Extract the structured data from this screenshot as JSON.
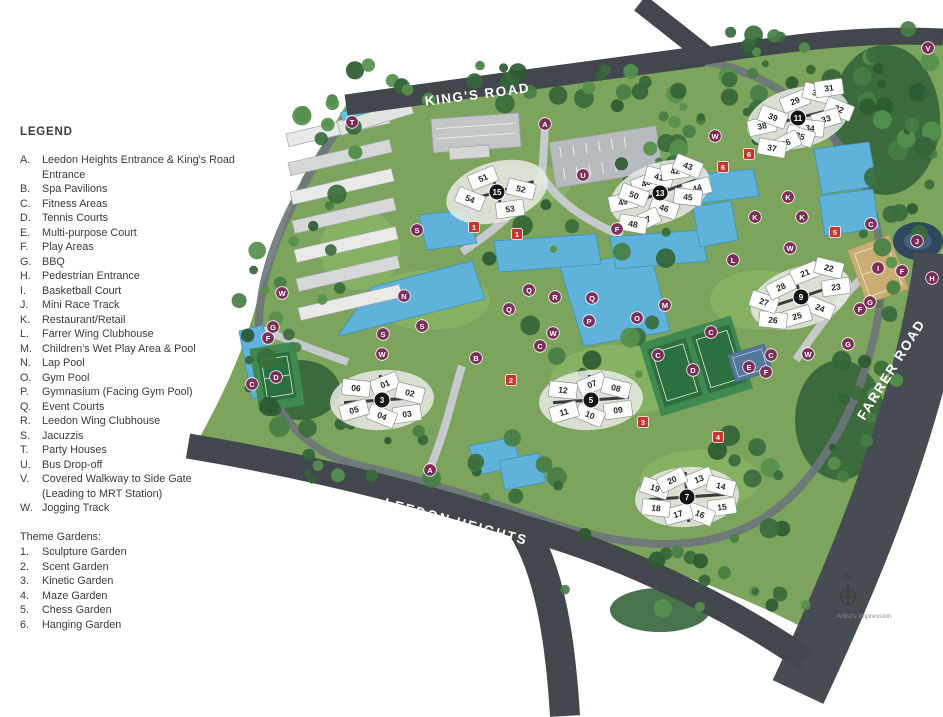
{
  "legend": {
    "title": "LEGEND",
    "items": [
      {
        "key": "A.",
        "label": "Leedon Heights Entrance & King's Road Entrance"
      },
      {
        "key": "B.",
        "label": "Spa Pavilions"
      },
      {
        "key": "C.",
        "label": "Fitness Areas"
      },
      {
        "key": "D.",
        "label": "Tennis Courts"
      },
      {
        "key": "E.",
        "label": "Multi-purpose Court"
      },
      {
        "key": "F.",
        "label": "Play Areas"
      },
      {
        "key": "G.",
        "label": "BBQ"
      },
      {
        "key": "H.",
        "label": "Pedestrian Entrance"
      },
      {
        "key": "I.",
        "label": "Basketball Court"
      },
      {
        "key": "J.",
        "label": "Mini Race Track"
      },
      {
        "key": "K.",
        "label": "Restaurant/Retail"
      },
      {
        "key": "L.",
        "label": "Farrer Wing Clubhouse"
      },
      {
        "key": "M.",
        "label": "Children's Wet Play Area & Pool"
      },
      {
        "key": "N.",
        "label": "Lap Pool"
      },
      {
        "key": "O.",
        "label": "Gym Pool"
      },
      {
        "key": "P.",
        "label": "Gymnasium (Facing Gym Pool)"
      },
      {
        "key": "Q.",
        "label": "Event Courts"
      },
      {
        "key": "R.",
        "label": "Leedon Wing Clubhouse"
      },
      {
        "key": "S.",
        "label": "Jacuzzis"
      },
      {
        "key": "T.",
        "label": "Party Houses"
      },
      {
        "key": "U.",
        "label": "Bus Drop-off"
      },
      {
        "key": "V.",
        "label": "Covered Walkway to Side Gate",
        "label2": "(Leading to MRT Station)"
      },
      {
        "key": "W.",
        "label": "Jogging Track"
      }
    ],
    "theme_gardens": {
      "title": "Theme Gardens:",
      "items": [
        {
          "key": "1.",
          "label": "Sculpture Garden"
        },
        {
          "key": "2.",
          "label": "Scent Garden"
        },
        {
          "key": "3.",
          "label": "Kinetic Garden"
        },
        {
          "key": "4.",
          "label": "Maze Garden"
        },
        {
          "key": "5.",
          "label": "Chess Garden"
        },
        {
          "key": "6.",
          "label": "Hanging Garden"
        }
      ]
    }
  },
  "map": {
    "roads": [
      {
        "name": "KING'S ROAD"
      },
      {
        "name": "FARRER ROAD"
      },
      {
        "name": "LEEDON HEIGHTS"
      }
    ],
    "compass": {
      "label": "N"
    },
    "caption": "Artist's Impression",
    "colors": {
      "road_dark": "#41474d",
      "site_green": "#7da45c",
      "tree_green": "#35663c",
      "pool_blue": "#5fb3da",
      "court_green": "#2c7040",
      "basketball_tan": "#c9ad73",
      "facility_marker": "#7d2857",
      "garden_marker": "#c9342b",
      "block_circle": "#141414"
    },
    "clusters": [
      {
        "block": "15",
        "cx": 497,
        "cy": 192,
        "tilt": -16,
        "buildings": [
          {
            "n": "51",
            "x": 483,
            "y": 178
          },
          {
            "n": "52",
            "x": 521,
            "y": 189
          },
          {
            "n": "53",
            "x": 510,
            "y": 209
          },
          {
            "n": "54",
            "x": 470,
            "y": 199
          }
        ]
      },
      {
        "block": "13",
        "cx": 660,
        "cy": 193,
        "tilt": -20,
        "buildings": [
          {
            "n": "40",
            "x": 646,
            "y": 183
          },
          {
            "n": "41",
            "x": 659,
            "y": 177
          },
          {
            "n": "42",
            "x": 675,
            "y": 171
          },
          {
            "n": "43",
            "x": 688,
            "y": 166
          },
          {
            "n": "44",
            "x": 697,
            "y": 188
          },
          {
            "n": "45",
            "x": 688,
            "y": 197
          },
          {
            "n": "46",
            "x": 664,
            "y": 208
          },
          {
            "n": "47",
            "x": 646,
            "y": 220
          },
          {
            "n": "48",
            "x": 633,
            "y": 224
          },
          {
            "n": "49",
            "x": 623,
            "y": 202
          },
          {
            "n": "50",
            "x": 634,
            "y": 195
          }
        ]
      },
      {
        "block": "11",
        "cx": 798,
        "cy": 118,
        "tilt": -14,
        "buildings": [
          {
            "n": "29",
            "x": 795,
            "y": 101
          },
          {
            "n": "30",
            "x": 817,
            "y": 93
          },
          {
            "n": "31",
            "x": 829,
            "y": 88
          },
          {
            "n": "32",
            "x": 839,
            "y": 109
          },
          {
            "n": "33",
            "x": 826,
            "y": 119
          },
          {
            "n": "34",
            "x": 810,
            "y": 128
          },
          {
            "n": "35",
            "x": 800,
            "y": 136
          },
          {
            "n": "36",
            "x": 786,
            "y": 143
          },
          {
            "n": "37",
            "x": 772,
            "y": 148
          },
          {
            "n": "38",
            "x": 762,
            "y": 126
          },
          {
            "n": "39",
            "x": 773,
            "y": 117
          }
        ]
      },
      {
        "block": "9",
        "cx": 801,
        "cy": 297,
        "tilt": -18,
        "buildings": [
          {
            "n": "21",
            "x": 805,
            "y": 273
          },
          {
            "n": "22",
            "x": 829,
            "y": 268
          },
          {
            "n": "23",
            "x": 836,
            "y": 287
          },
          {
            "n": "24",
            "x": 820,
            "y": 308
          },
          {
            "n": "25",
            "x": 797,
            "y": 316
          },
          {
            "n": "26",
            "x": 773,
            "y": 320
          },
          {
            "n": "27",
            "x": 764,
            "y": 302
          },
          {
            "n": "28",
            "x": 781,
            "y": 287
          }
        ]
      },
      {
        "block": "3",
        "cx": 382,
        "cy": 400,
        "tilt": -4,
        "buildings": [
          {
            "n": "01",
            "x": 385,
            "y": 384
          },
          {
            "n": "02",
            "x": 410,
            "y": 393
          },
          {
            "n": "03",
            "x": 407,
            "y": 414
          },
          {
            "n": "04",
            "x": 382,
            "y": 416
          },
          {
            "n": "05",
            "x": 354,
            "y": 410
          },
          {
            "n": "06",
            "x": 356,
            "y": 388
          }
        ]
      },
      {
        "block": "5",
        "cx": 591,
        "cy": 400,
        "tilt": -4,
        "buildings": [
          {
            "n": "07",
            "x": 592,
            "y": 384
          },
          {
            "n": "08",
            "x": 616,
            "y": 388
          },
          {
            "n": "09",
            "x": 618,
            "y": 410
          },
          {
            "n": "10",
            "x": 590,
            "y": 415
          },
          {
            "n": "11",
            "x": 564,
            "y": 412
          },
          {
            "n": "12",
            "x": 563,
            "y": 390
          }
        ]
      },
      {
        "block": "7",
        "cx": 687,
        "cy": 497,
        "tilt": -4,
        "buildings": [
          {
            "n": "13",
            "x": 699,
            "y": 479
          },
          {
            "n": "14",
            "x": 721,
            "y": 486
          },
          {
            "n": "15",
            "x": 722,
            "y": 507
          },
          {
            "n": "16",
            "x": 700,
            "y": 514
          },
          {
            "n": "17",
            "x": 678,
            "y": 514
          },
          {
            "n": "18",
            "x": 656,
            "y": 508
          },
          {
            "n": "19",
            "x": 655,
            "y": 488
          },
          {
            "n": "20",
            "x": 672,
            "y": 480
          }
        ]
      }
    ],
    "letter_markers": [
      {
        "label": "A",
        "x": 545,
        "y": 124
      },
      {
        "label": "A",
        "x": 430,
        "y": 470
      },
      {
        "label": "B",
        "x": 476,
        "y": 358
      },
      {
        "label": "C",
        "x": 252,
        "y": 384
      },
      {
        "label": "C",
        "x": 540,
        "y": 346
      },
      {
        "label": "C",
        "x": 658,
        "y": 355
      },
      {
        "label": "C",
        "x": 711,
        "y": 332
      },
      {
        "label": "C",
        "x": 771,
        "y": 355
      },
      {
        "label": "C",
        "x": 871,
        "y": 224
      },
      {
        "label": "D",
        "x": 276,
        "y": 377
      },
      {
        "label": "D",
        "x": 693,
        "y": 370
      },
      {
        "label": "E",
        "x": 749,
        "y": 367
      },
      {
        "label": "F",
        "x": 268,
        "y": 338
      },
      {
        "label": "F",
        "x": 617,
        "y": 229
      },
      {
        "label": "F",
        "x": 766,
        "y": 372
      },
      {
        "label": "F",
        "x": 860,
        "y": 309
      },
      {
        "label": "F",
        "x": 902,
        "y": 271
      },
      {
        "label": "G",
        "x": 273,
        "y": 327
      },
      {
        "label": "G",
        "x": 848,
        "y": 344
      },
      {
        "label": "G",
        "x": 870,
        "y": 302
      },
      {
        "label": "H",
        "x": 932,
        "y": 278
      },
      {
        "label": "I",
        "x": 878,
        "y": 268
      },
      {
        "label": "J",
        "x": 917,
        "y": 241
      },
      {
        "label": "K",
        "x": 755,
        "y": 217
      },
      {
        "label": "K",
        "x": 788,
        "y": 197
      },
      {
        "label": "K",
        "x": 802,
        "y": 217
      },
      {
        "label": "L",
        "x": 733,
        "y": 260
      },
      {
        "label": "M",
        "x": 665,
        "y": 305
      },
      {
        "label": "N",
        "x": 404,
        "y": 296
      },
      {
        "label": "O",
        "x": 637,
        "y": 318
      },
      {
        "label": "P",
        "x": 589,
        "y": 321
      },
      {
        "label": "Q",
        "x": 509,
        "y": 309
      },
      {
        "label": "Q",
        "x": 529,
        "y": 290
      },
      {
        "label": "Q",
        "x": 592,
        "y": 298
      },
      {
        "label": "R",
        "x": 555,
        "y": 297
      },
      {
        "label": "S",
        "x": 383,
        "y": 334
      },
      {
        "label": "S",
        "x": 417,
        "y": 230
      },
      {
        "label": "S",
        "x": 422,
        "y": 326
      },
      {
        "label": "T",
        "x": 352,
        "y": 122
      },
      {
        "label": "U",
        "x": 583,
        "y": 175
      },
      {
        "label": "V",
        "x": 928,
        "y": 48
      },
      {
        "label": "W",
        "x": 282,
        "y": 293
      },
      {
        "label": "W",
        "x": 382,
        "y": 354
      },
      {
        "label": "W",
        "x": 553,
        "y": 333
      },
      {
        "label": "W",
        "x": 715,
        "y": 136
      },
      {
        "label": "W",
        "x": 790,
        "y": 248
      },
      {
        "label": "W",
        "x": 808,
        "y": 354
      }
    ],
    "garden_markers": [
      {
        "label": "1",
        "x": 474,
        "y": 227
      },
      {
        "label": "1",
        "x": 517,
        "y": 234
      },
      {
        "label": "2",
        "x": 511,
        "y": 380
      },
      {
        "label": "3",
        "x": 643,
        "y": 422
      },
      {
        "label": "4",
        "x": 718,
        "y": 437
      },
      {
        "label": "5",
        "x": 835,
        "y": 232
      },
      {
        "label": "6",
        "x": 723,
        "y": 167
      },
      {
        "label": "6",
        "x": 749,
        "y": 154
      }
    ]
  }
}
